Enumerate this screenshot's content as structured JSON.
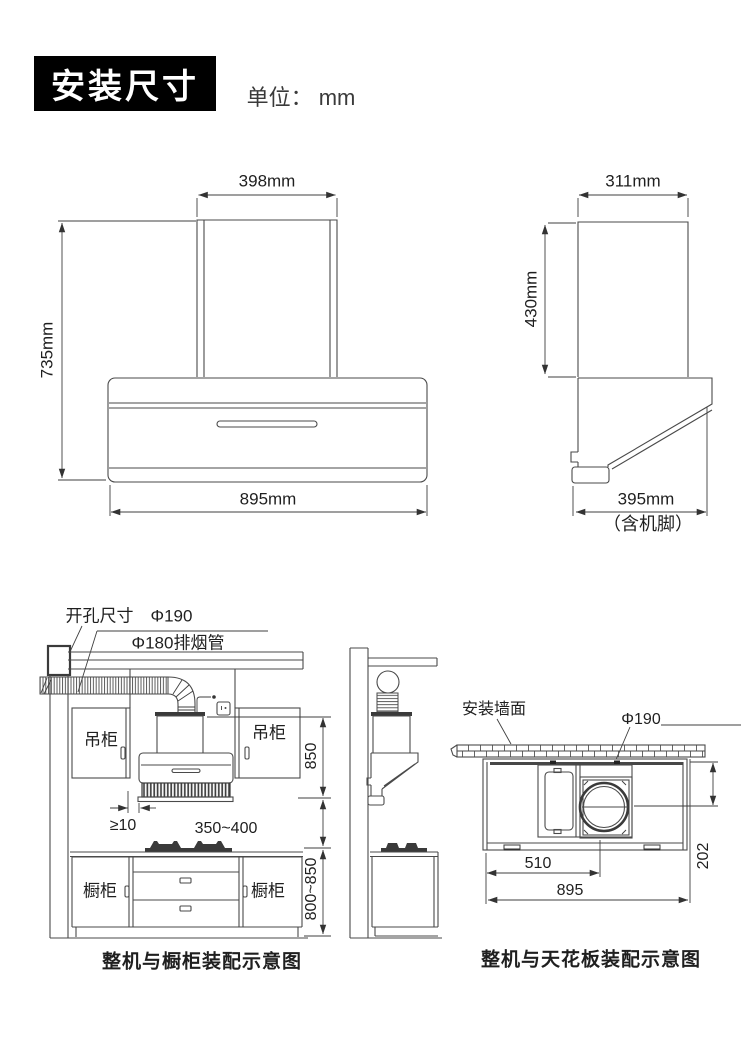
{
  "header": {
    "title": "安装尺寸",
    "unit_label": "单位： mm"
  },
  "front_view": {
    "width_top": "398mm",
    "height": "735mm",
    "width_bottom": "895mm"
  },
  "side_view": {
    "width_top": "311mm",
    "height": "430mm",
    "depth": "395mm",
    "depth_note": "（含机脚）"
  },
  "cabinet_view": {
    "hole_label": "开孔尺寸　Φ190",
    "duct_label": "Φ180排烟管",
    "upper_cabinet_left": "吊柜",
    "upper_cabinet_right": "吊柜",
    "hood_zone_height": "850",
    "gap_min": "≥10",
    "hood_to_counter": "350~400",
    "base_cabinet_left": "橱柜",
    "base_cabinet_right": "橱柜",
    "counter_height": "800~850",
    "caption": "整机与橱柜装配示意图"
  },
  "ceiling_view": {
    "wall_label": "安装墙面",
    "outlet_label": "Φ190",
    "outlet_offset_depth": "202",
    "outlet_offset_center": "510",
    "machine_width": "895",
    "caption": "整机与天花板装配示意图"
  }
}
